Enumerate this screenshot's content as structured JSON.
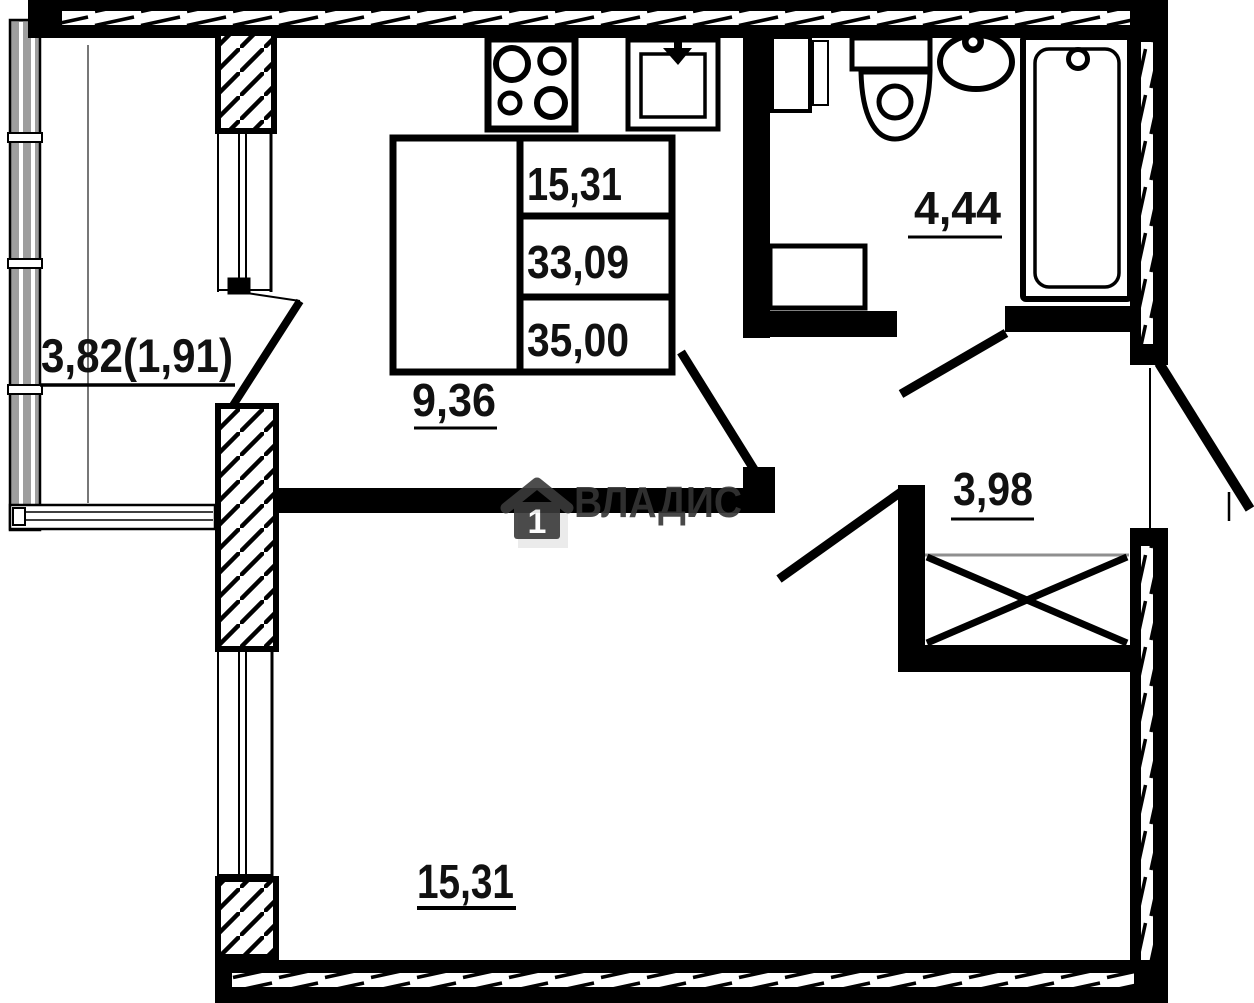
{
  "watermark": {
    "brand": "ВЛАДИС",
    "logo_number": "1"
  },
  "area_table": {
    "rows": [
      "15,31",
      "33,09",
      "35,00"
    ]
  },
  "rooms": {
    "balcony": {
      "label": "3,82(1,91)"
    },
    "kitchen": {
      "label": "9,36"
    },
    "bathroom": {
      "label": "4,44"
    },
    "hallway": {
      "label": "3,98"
    },
    "living_room": {
      "label": "15,31"
    }
  },
  "colors": {
    "walls": "#000000",
    "watermark_text": "#3a3a3a",
    "watermark_shadow": "#ebebeb",
    "background": "#ffffff"
  }
}
